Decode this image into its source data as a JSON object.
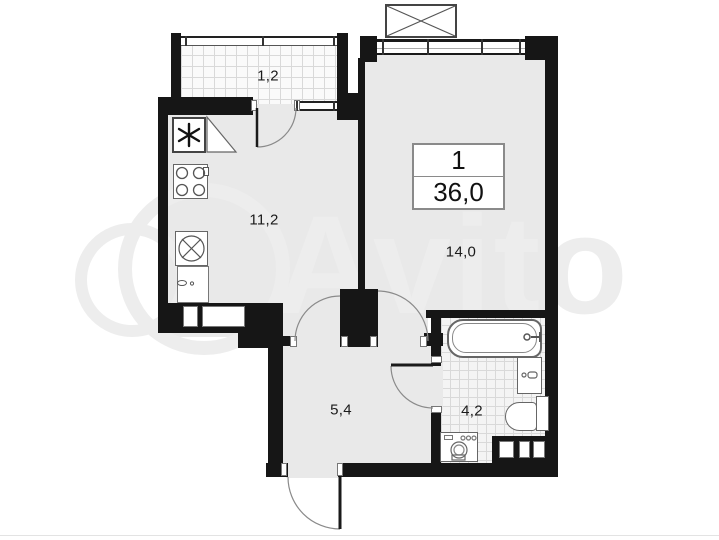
{
  "plan": {
    "title": "1-room apartment floor plan",
    "watermark": "Avito",
    "info_box": {
      "rooms_count": "1",
      "total_area": "36,0"
    },
    "rooms": [
      {
        "id": "balcony",
        "area_label": "1,2"
      },
      {
        "id": "kitchen",
        "area_label": "11,2"
      },
      {
        "id": "living-room",
        "area_label": "14,0"
      },
      {
        "id": "hallway",
        "area_label": "5,4"
      },
      {
        "id": "bathroom",
        "area_label": "4,2"
      }
    ],
    "fixtures": [
      "vent-shaft",
      "stove",
      "kitchen-sink",
      "cabinet",
      "bathtub",
      "wash-basin",
      "toilet",
      "washing-machine"
    ],
    "colors": {
      "wall": "#161616",
      "room_fill": "#e9e9e9",
      "tile_fill": "#f4f4f4",
      "tile_grid": "#d9d9d9",
      "fixture_stroke": "#666666",
      "label_text": "#1a1a1a",
      "watermark": "#ededed"
    }
  }
}
